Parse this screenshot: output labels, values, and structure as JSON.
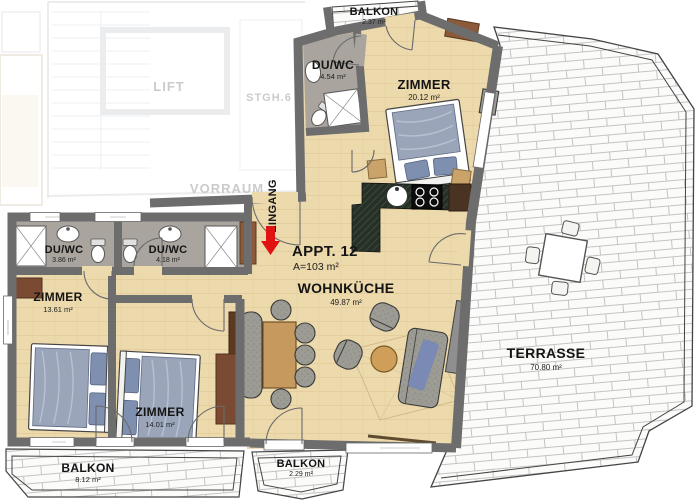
{
  "plan": {
    "apartment": {
      "label": "APPT. 12",
      "area": "A=103 m²"
    },
    "entrance": {
      "label": "EINGANG"
    },
    "rooms": [
      {
        "key": "balkon-top",
        "name": "BALKON",
        "area": "2.37 m²"
      },
      {
        "key": "duwc-top",
        "name": "DU/WC",
        "area": "4.54 m²"
      },
      {
        "key": "zimmer-top",
        "name": "ZIMMER",
        "area": "20.12 m²"
      },
      {
        "key": "duwc-a",
        "name": "DU/WC",
        "area": "3.86 m²"
      },
      {
        "key": "duwc-b",
        "name": "DU/WC",
        "area": "4.18 m²"
      },
      {
        "key": "zimmer-left",
        "name": "ZIMMER",
        "area": "13.61 m²"
      },
      {
        "key": "zimmer-bottom",
        "name": "ZIMMER",
        "area": "14.01 m²"
      },
      {
        "key": "wohnkueche",
        "name": "WOHNKÜCHE",
        "area": "49.87 m²"
      },
      {
        "key": "terrasse",
        "name": "TERRASSE",
        "area": "70.80 m²"
      },
      {
        "key": "balkon-left",
        "name": "BALKON",
        "area": "8.12 m²"
      },
      {
        "key": "balkon-mid",
        "name": "BALKON",
        "area": "2.29 m²"
      }
    ],
    "shared_areas": [
      {
        "name": "LIFT"
      },
      {
        "name": "STGH.6"
      },
      {
        "name": "VORRAUM"
      }
    ],
    "colors": {
      "wall": "#6d6d6d",
      "floor": "#ecd9ac",
      "bath": "#a9a49d",
      "accent_red": "#e01212",
      "brick_line": "#c4c4c4",
      "furniture": "#9c9c94",
      "wood": "#c69a5e",
      "counter": "#263026",
      "textile": "#9aa5b9",
      "pillow": "#7e8fb0",
      "faded_text": "#cbcbcb",
      "label": "#141414"
    }
  }
}
